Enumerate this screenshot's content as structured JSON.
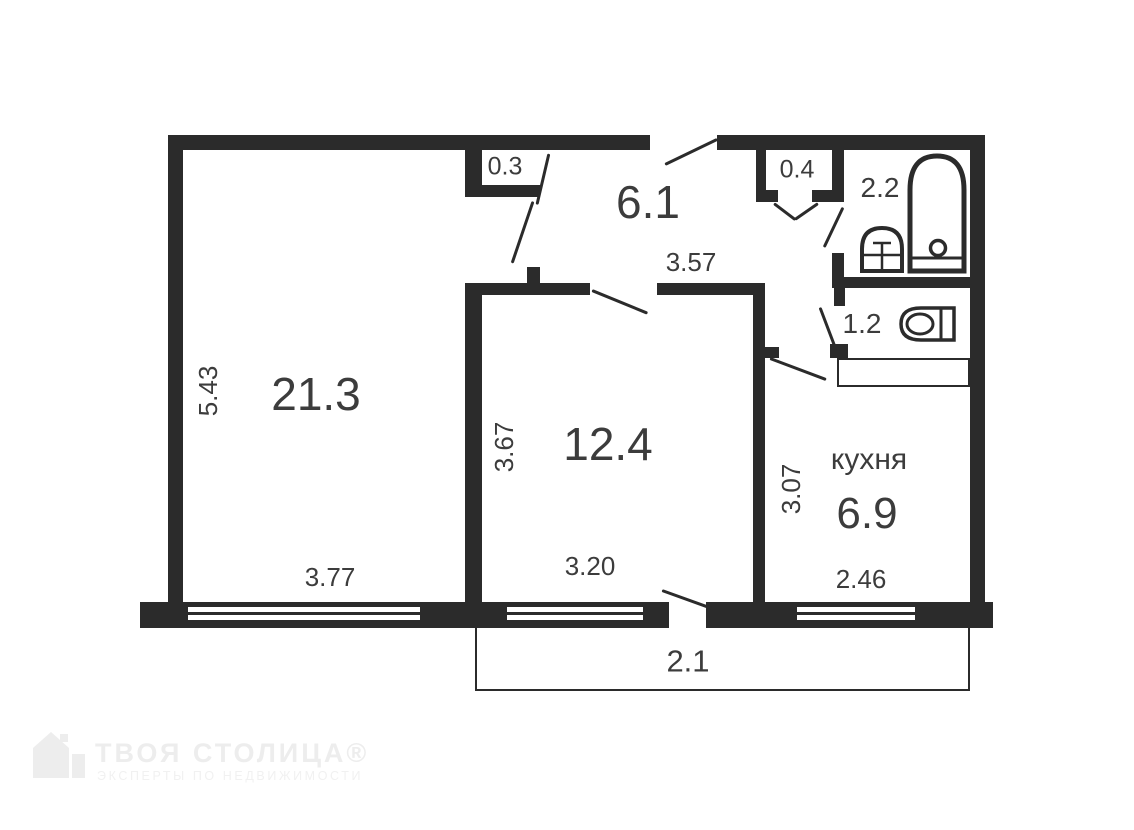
{
  "rooms": {
    "living": {
      "area": "21.3",
      "width": "3.77",
      "height": "5.43"
    },
    "bedroom": {
      "area": "12.4",
      "width": "3.20",
      "height": "3.67"
    },
    "kitchen": {
      "name": "кухня",
      "area": "6.9",
      "width": "2.46",
      "height": "3.07"
    },
    "hallway": {
      "area": "6.1",
      "width": "3.57"
    },
    "storage_small": {
      "area": "0.3"
    },
    "storage": {
      "area": "0.4"
    },
    "bathroom": {
      "area": "2.2"
    },
    "toilet": {
      "area": "1.2"
    },
    "balcony": {
      "area": "2.1"
    }
  },
  "watermark": {
    "title": "ТВОЯ СТОЛИЦА®",
    "subtitle": "ЭКСПЕРТЫ ПО НЕДВИЖИМОСТИ"
  },
  "colors": {
    "wall": "#2b2b2b",
    "text": "#3c3c3c",
    "watermark": "#ededed",
    "background": "#ffffff"
  }
}
